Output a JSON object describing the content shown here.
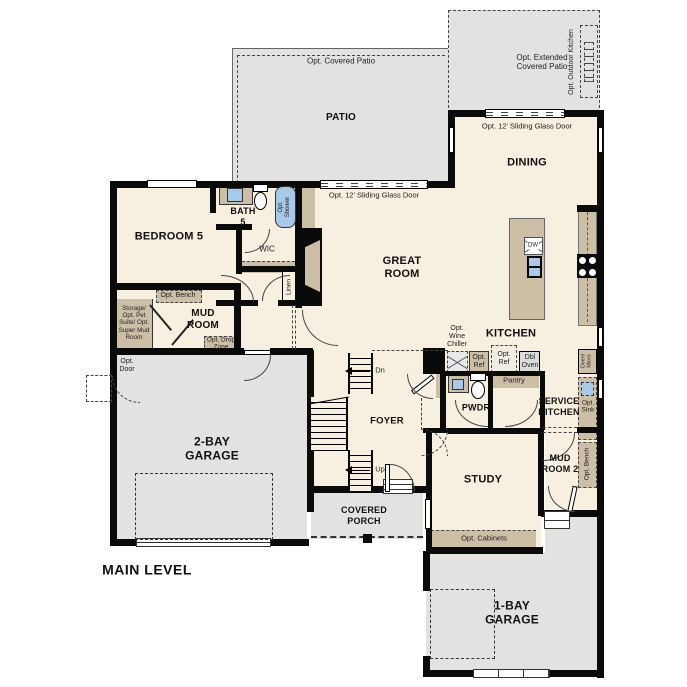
{
  "title": "MAIN LEVEL",
  "colors": {
    "wall": "#0a0a0a",
    "interior": "#f7efe0",
    "concrete": "#e3e2e0",
    "casework": "#ccbfa6",
    "fixture_blue": "#a9c9e8"
  },
  "rooms": {
    "patio": {
      "label": "PATIO"
    },
    "extended_patio": {
      "label": "Opt. Extended\nCovered Patio"
    },
    "outdoor_kitchen": {
      "label": "Opt. Outdoor Kitchen"
    },
    "dining": {
      "label": "DINING"
    },
    "great_room": {
      "label": "GREAT\nROOM"
    },
    "kitchen": {
      "label": "KITCHEN"
    },
    "bedroom5": {
      "label": "BEDROOM 5"
    },
    "bath5": {
      "label": "BATH\n5"
    },
    "wic": {
      "label": "WIC"
    },
    "linen": {
      "label": "Linen"
    },
    "mud_room": {
      "label": "MUD\nROOM"
    },
    "garage2": {
      "label": "2-BAY\nGARAGE"
    },
    "foyer": {
      "label": "FOYER"
    },
    "pwdr": {
      "label": "PWDR"
    },
    "service_kitchen": {
      "label": "SERVICE\nKITCHEN"
    },
    "mud_room2": {
      "label": "MUD\nROOM 2"
    },
    "study": {
      "label": "STUDY"
    },
    "covered_porch": {
      "label": "COVERED\nPORCH"
    },
    "garage1": {
      "label": "1-BAY\nGARAGE"
    }
  },
  "annotations": {
    "opt_covered_patio": "Opt. Covered Patio",
    "sliding_door_great": "Opt. 12' Sliding Glass Door",
    "sliding_door_dining": "Opt. 12' Sliding Glass Door",
    "opt_shower": "Opt.\nShower",
    "storage": "Storage/\nOpt. Pet\nSuite/ Opt.\nSuper Mud\nRoom",
    "opt_bench_mud": "Opt. Bench",
    "opt_drop_zone": "Opt. Drop\nZone",
    "opt_door": "Opt.\nDoor",
    "opt_wine_chiller": "Opt.\nWine\nChiller",
    "opt_ref_1": "Opt.\nRef",
    "opt_ref_2": "Opt.\nRef",
    "dbl_oven": "Dbl\nOven",
    "pantry": "Pantry",
    "oven_micro": "Oven/\nMicro",
    "opt_sink": "Opt.\nSink",
    "opt_bench_mud2": "Opt. Bench",
    "opt_cabinets": "Opt. Cabinets",
    "stair_down": "Dn",
    "stair_up": "Up",
    "dishwasher": "DW"
  }
}
